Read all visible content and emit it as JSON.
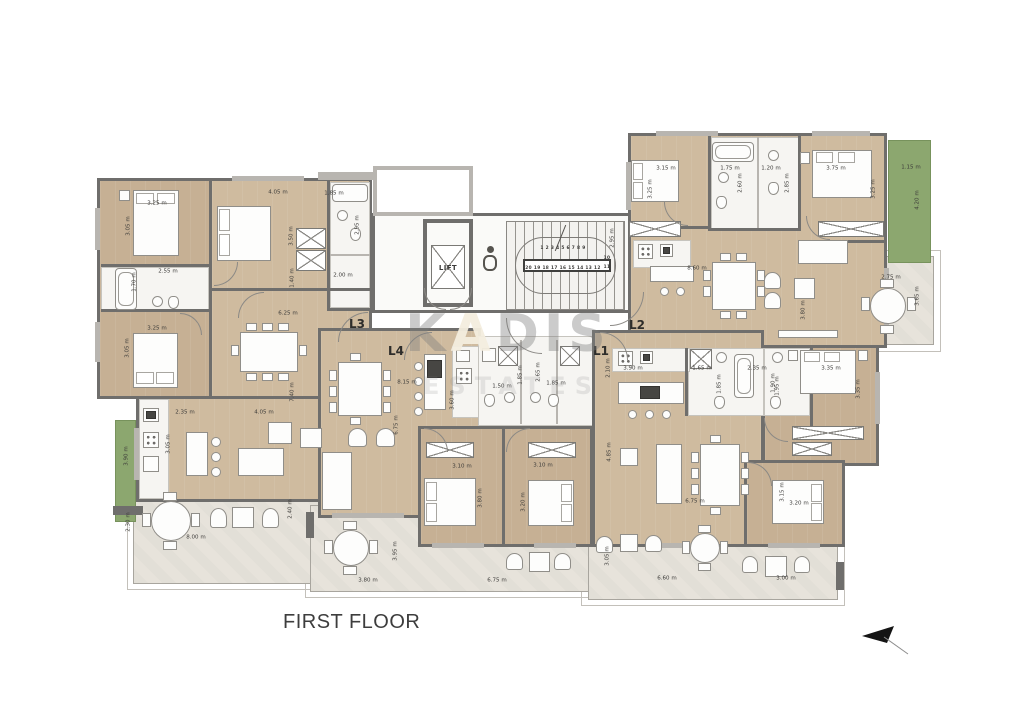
{
  "title": "FIRST FLOOR",
  "watermark": {
    "part1": "K",
    "part2": "A",
    "part3": "DIS",
    "line2": "ESTATES"
  },
  "core": {
    "lift": "LIFT"
  },
  "colors": {
    "wood": "#c6b094",
    "wood_light": "#cfbb9f",
    "terrace": "#e7e3db",
    "wall_dark": "#6f6e6c",
    "wall_light": "#b8b5b0",
    "planter_green": "#8ca76f",
    "bath_white": "#f6f5f2"
  },
  "units": [
    "L1",
    "L2",
    "L3",
    "L4"
  ],
  "labels": [
    {
      "t": "3.25 m",
      "x": 157,
      "y": 203,
      "k": "dim"
    },
    {
      "t": "3.05 m",
      "x": 128,
      "y": 226,
      "k": "dimv"
    },
    {
      "t": "4.05 m",
      "x": 278,
      "y": 192,
      "k": "dim"
    },
    {
      "t": "1.85 m",
      "x": 334,
      "y": 193,
      "k": "dim"
    },
    {
      "t": "2.95 m",
      "x": 357,
      "y": 225,
      "k": "dimv"
    },
    {
      "t": "3.50 m",
      "x": 291,
      "y": 236,
      "k": "dimv"
    },
    {
      "t": "2.55 m",
      "x": 168,
      "y": 271,
      "k": "dim"
    },
    {
      "t": "1.70 m",
      "x": 134,
      "y": 282,
      "k": "dimv"
    },
    {
      "t": "1.40 m",
      "x": 292,
      "y": 278,
      "k": "dimv"
    },
    {
      "t": "2.00 m",
      "x": 343,
      "y": 275,
      "k": "dim"
    },
    {
      "t": "6.25 m",
      "x": 288,
      "y": 313,
      "k": "dim"
    },
    {
      "t": "3.25 m",
      "x": 157,
      "y": 328,
      "k": "dim"
    },
    {
      "t": "3.05 m",
      "x": 127,
      "y": 348,
      "k": "dimv"
    },
    {
      "t": "7.40 m",
      "x": 292,
      "y": 392,
      "k": "dimv"
    },
    {
      "t": "2.35 m",
      "x": 185,
      "y": 412,
      "k": "dim"
    },
    {
      "t": "4.05 m",
      "x": 264,
      "y": 412,
      "k": "dim"
    },
    {
      "t": "3.90 m",
      "x": 126,
      "y": 456,
      "k": "dimv"
    },
    {
      "t": "3.05 m",
      "x": 168,
      "y": 444,
      "k": "dimv"
    },
    {
      "t": "2.30 m",
      "x": 128,
      "y": 522,
      "k": "dimv"
    },
    {
      "t": "8.00 m",
      "x": 196,
      "y": 537,
      "k": "dim"
    },
    {
      "t": "2.40 m",
      "x": 290,
      "y": 509,
      "k": "dimv"
    },
    {
      "t": "2.95 m",
      "x": 612,
      "y": 238,
      "k": "dimv"
    },
    {
      "t": "1 2 3 4 5 6 7 8 9",
      "x": 563,
      "y": 248,
      "k": "num"
    },
    {
      "t": "10",
      "x": 607,
      "y": 258,
      "k": "num"
    },
    {
      "t": "11",
      "x": 607,
      "y": 267,
      "k": "num"
    },
    {
      "t": "20 19 18 17 16 15 14 13 12",
      "x": 563,
      "y": 268,
      "k": "num"
    },
    {
      "t": "L3",
      "x": 357,
      "y": 324,
      "k": "unit"
    },
    {
      "t": "L4",
      "x": 396,
      "y": 351,
      "k": "unit"
    },
    {
      "t": "L1",
      "x": 601,
      "y": 351,
      "k": "unit"
    },
    {
      "t": "L2",
      "x": 637,
      "y": 325,
      "k": "unit"
    },
    {
      "t": "8.15 m",
      "x": 407,
      "y": 382,
      "k": "dim"
    },
    {
      "t": "3.60 m",
      "x": 452,
      "y": 400,
      "k": "dimv"
    },
    {
      "t": "6.75 m",
      "x": 396,
      "y": 425,
      "k": "dimv"
    },
    {
      "t": "1.50 m",
      "x": 502,
      "y": 386,
      "k": "dim"
    },
    {
      "t": "1.85 m",
      "x": 520,
      "y": 375,
      "k": "dimv"
    },
    {
      "t": "2.65 m",
      "x": 538,
      "y": 372,
      "k": "dimv"
    },
    {
      "t": "1.85 m",
      "x": 556,
      "y": 383,
      "k": "dim"
    },
    {
      "t": "3.10 m",
      "x": 462,
      "y": 466,
      "k": "dim"
    },
    {
      "t": "3.10 m",
      "x": 543,
      "y": 465,
      "k": "dim"
    },
    {
      "t": "3.80 m",
      "x": 480,
      "y": 498,
      "k": "dimv"
    },
    {
      "t": "3.20 m",
      "x": 523,
      "y": 502,
      "k": "dimv"
    },
    {
      "t": "2.10 m",
      "x": 608,
      "y": 368,
      "k": "dimv"
    },
    {
      "t": "3.90 m",
      "x": 633,
      "y": 368,
      "k": "dim"
    },
    {
      "t": "1.65 m",
      "x": 702,
      "y": 368,
      "k": "dim"
    },
    {
      "t": "2.35 m",
      "x": 757,
      "y": 368,
      "k": "dim"
    },
    {
      "t": "1.85 m",
      "x": 719,
      "y": 384,
      "k": "dimv"
    },
    {
      "t": "1.90 m",
      "x": 773,
      "y": 383,
      "k": "dimv"
    },
    {
      "t": "4.85 m",
      "x": 609,
      "y": 452,
      "k": "dimv"
    },
    {
      "t": "6.75 m",
      "x": 695,
      "y": 501,
      "k": "dim"
    },
    {
      "t": "3.15 m",
      "x": 782,
      "y": 492,
      "k": "dimv"
    },
    {
      "t": "3.20 m",
      "x": 799,
      "y": 503,
      "k": "dim"
    },
    {
      "t": "3.15 m",
      "x": 666,
      "y": 168,
      "k": "dim"
    },
    {
      "t": "3.25 m",
      "x": 650,
      "y": 189,
      "k": "dimv"
    },
    {
      "t": "1.75 m",
      "x": 730,
      "y": 168,
      "k": "dim"
    },
    {
      "t": "2.60 m",
      "x": 740,
      "y": 183,
      "k": "dimv"
    },
    {
      "t": "1.20 m",
      "x": 771,
      "y": 168,
      "k": "dim"
    },
    {
      "t": "2.85 m",
      "x": 787,
      "y": 183,
      "k": "dimv"
    },
    {
      "t": "3.75 m",
      "x": 836,
      "y": 168,
      "k": "dim"
    },
    {
      "t": "3.25 m",
      "x": 873,
      "y": 189,
      "k": "dimv"
    },
    {
      "t": "1.15 m",
      "x": 911,
      "y": 167,
      "k": "dim"
    },
    {
      "t": "4.20 m",
      "x": 917,
      "y": 200,
      "k": "dimv"
    },
    {
      "t": "8.60 m",
      "x": 697,
      "y": 268,
      "k": "dim"
    },
    {
      "t": "3.80 m",
      "x": 803,
      "y": 310,
      "k": "dimv"
    },
    {
      "t": "2.75 m",
      "x": 891,
      "y": 277,
      "k": "dim"
    },
    {
      "t": "3.65 m",
      "x": 917,
      "y": 296,
      "k": "dimv"
    },
    {
      "t": "3.35 m",
      "x": 831,
      "y": 368,
      "k": "dim"
    },
    {
      "t": "1.95 m",
      "x": 777,
      "y": 386,
      "k": "dimv"
    },
    {
      "t": "3.35 m",
      "x": 858,
      "y": 389,
      "k": "dimv"
    },
    {
      "t": "3.80 m",
      "x": 368,
      "y": 580,
      "k": "dim"
    },
    {
      "t": "3.95 m",
      "x": 395,
      "y": 551,
      "k": "dimv"
    },
    {
      "t": "6.75 m",
      "x": 497,
      "y": 580,
      "k": "dim"
    },
    {
      "t": "3.05 m",
      "x": 607,
      "y": 556,
      "k": "dimv"
    },
    {
      "t": "6.60 m",
      "x": 667,
      "y": 578,
      "k": "dim"
    },
    {
      "t": "3.00 m",
      "x": 786,
      "y": 578,
      "k": "dim"
    }
  ]
}
